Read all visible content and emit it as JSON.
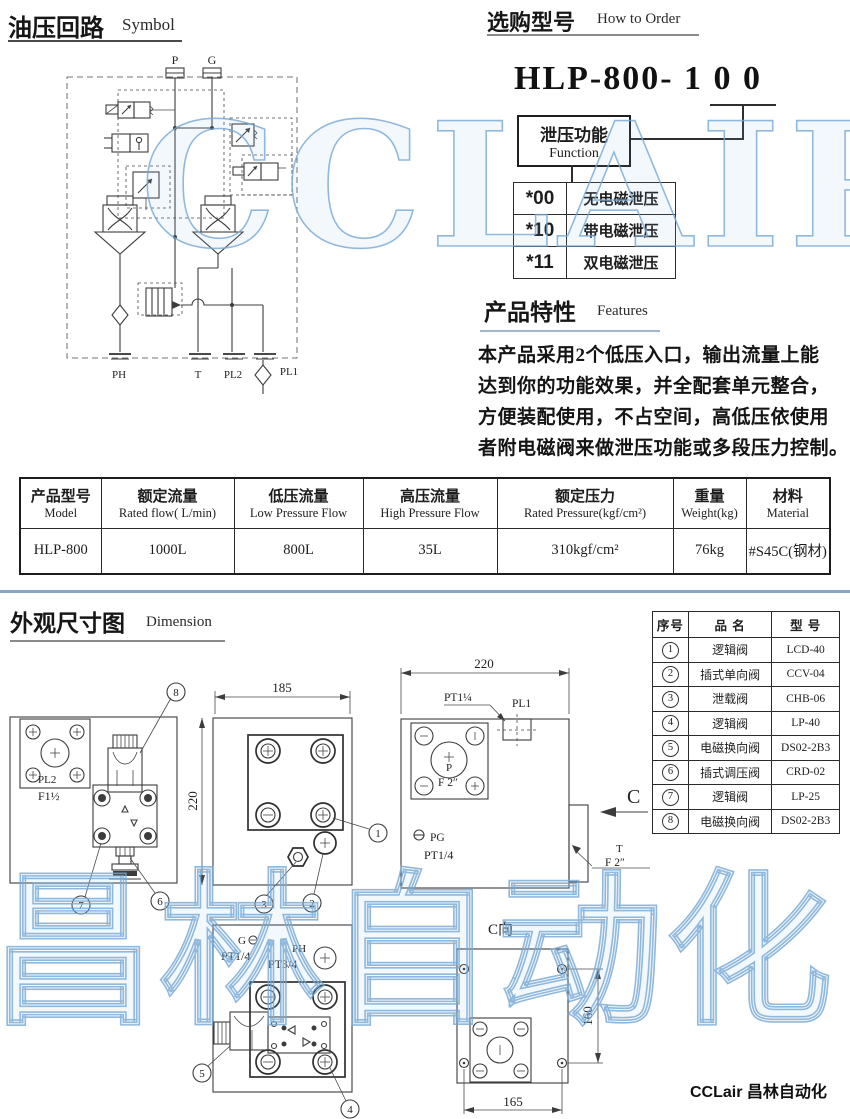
{
  "watermarks": {
    "top": "CCLAIR",
    "bottom": "昌林自动化",
    "color": "#79aeda"
  },
  "footer": {
    "brand": "CCLair 昌林自动化"
  },
  "symbol_section": {
    "title_cn": "油压回路",
    "title_en": "Symbol",
    "circuit": {
      "p": "P",
      "g": "G",
      "ph": "PH",
      "t": "T",
      "pl2": "PL2",
      "pl1": "PL1"
    }
  },
  "order_section": {
    "title_cn": "选购型号",
    "title_en": "How to Order",
    "model_code": "HLP-800- 1 0 0",
    "function_box": {
      "cn": "泄压功能",
      "en": "Function"
    },
    "options": [
      {
        "code": "*00",
        "label": "无电磁泄压"
      },
      {
        "code": "*10",
        "label": "带电磁泄压"
      },
      {
        "code": "*11",
        "label": "双电磁泄压"
      }
    ]
  },
  "features_section": {
    "title_cn": "产品特性",
    "title_en": "Features",
    "lines": [
      "本产品采用2个低压入口，输出流量上能",
      "达到你的功能效果，并全配套单元整合，",
      "方便装配使用，不占空间，高低压依使用",
      "者附电磁阀来做泄压功能或多段压力控制。"
    ]
  },
  "spec_table": {
    "headers": [
      {
        "cn": "产品型号",
        "en": "Model"
      },
      {
        "cn": "额定流量",
        "en": "Rated flow( L/min)"
      },
      {
        "cn": "低压流量",
        "en": "Low Pressure Flow"
      },
      {
        "cn": "高压流量",
        "en": "High Pressure Flow"
      },
      {
        "cn": "额定压力",
        "en": "Rated Pressure(kgf/cm²)"
      },
      {
        "cn": "重量",
        "en": "Weight(kg)"
      },
      {
        "cn": "材料",
        "en": "Material"
      }
    ],
    "rows": [
      [
        "HLP-800",
        "1000L",
        "800L",
        "35L",
        "310kgf/cm²",
        "76kg",
        "#S45C(钢材)"
      ]
    ]
  },
  "dimension_section": {
    "title_cn": "外观尺寸图",
    "title_en": "Dimension",
    "dims": {
      "d185": "185",
      "d220_left": "220",
      "d220_top": "220",
      "d160": "160",
      "d165": "165"
    },
    "labels": {
      "pl2": "PL2",
      "f1half": "F1½",
      "pt1quarter": "PT1¼",
      "pl1": "PL1",
      "p": "P",
      "f2": "F 2″",
      "pg": "PG",
      "pt14_a": "PT1/4",
      "c": "C",
      "t": "T",
      "f2_b": "F 2″",
      "g": "G",
      "pt14_b": "PT1/4",
      "ph": "PH",
      "pt34": "PT3/4",
      "c_view": "C向"
    },
    "callouts": {
      "c1": "1",
      "c2": "2",
      "c3": "3",
      "c4": "4",
      "c5": "5",
      "c6": "6",
      "c7": "7",
      "c8": "8"
    }
  },
  "parts_table": {
    "headers": [
      "序号",
      "品 名",
      "型 号"
    ],
    "rows": [
      {
        "no": "1",
        "name": "逻辑阀",
        "model": "LCD-40"
      },
      {
        "no": "2",
        "name": "插式单向阀",
        "model": "CCV-04"
      },
      {
        "no": "3",
        "name": "泄载阀",
        "model": "CHB-06"
      },
      {
        "no": "4",
        "name": "逻辑阀",
        "model": "LP-40"
      },
      {
        "no": "5",
        "name": "电磁换向阀",
        "model": "DS02-2B3"
      },
      {
        "no": "6",
        "name": "插式调压阀",
        "model": "CRD-02"
      },
      {
        "no": "7",
        "name": "逻辑阀",
        "model": "LP-25"
      },
      {
        "no": "8",
        "name": "电磁换向阀",
        "model": "DS02-2B3"
      }
    ]
  }
}
